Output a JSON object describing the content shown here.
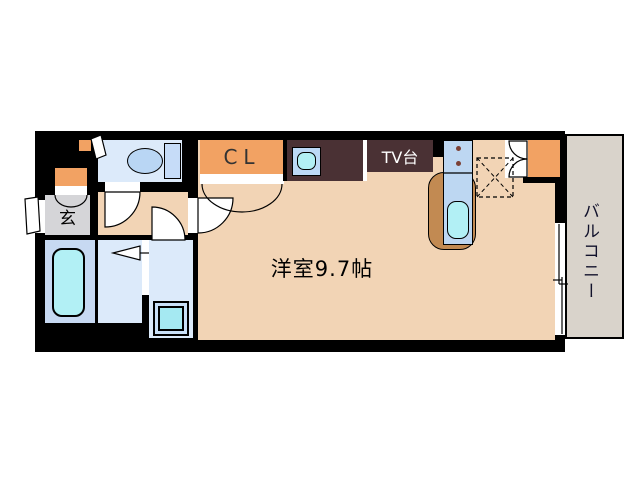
{
  "plan": {
    "type": "japanese-apartment-floorplan",
    "labels": {
      "genkan": "玄",
      "closet": "CL",
      "tv_stand": "TV台",
      "main_room": "洋室9.7帖",
      "balcony": "バルコニー"
    },
    "colors": {
      "wall": "#000000",
      "floor_main": "#F2D4B5",
      "genkan_gray": "#D5D5D8",
      "wet_room_blue": "#DCEAFA",
      "bath_blue": "#C7D9F2",
      "fixture_cyan": "#B2F0F5",
      "accent_orange": "#F2A263",
      "furniture_dark_brown": "#4A3134",
      "counter_brown": "#C28A52",
      "kitchen_unit_blue": "#BDD7F2",
      "balcony_gray": "#D9D3CB",
      "background": "#FFFFFF"
    }
  }
}
